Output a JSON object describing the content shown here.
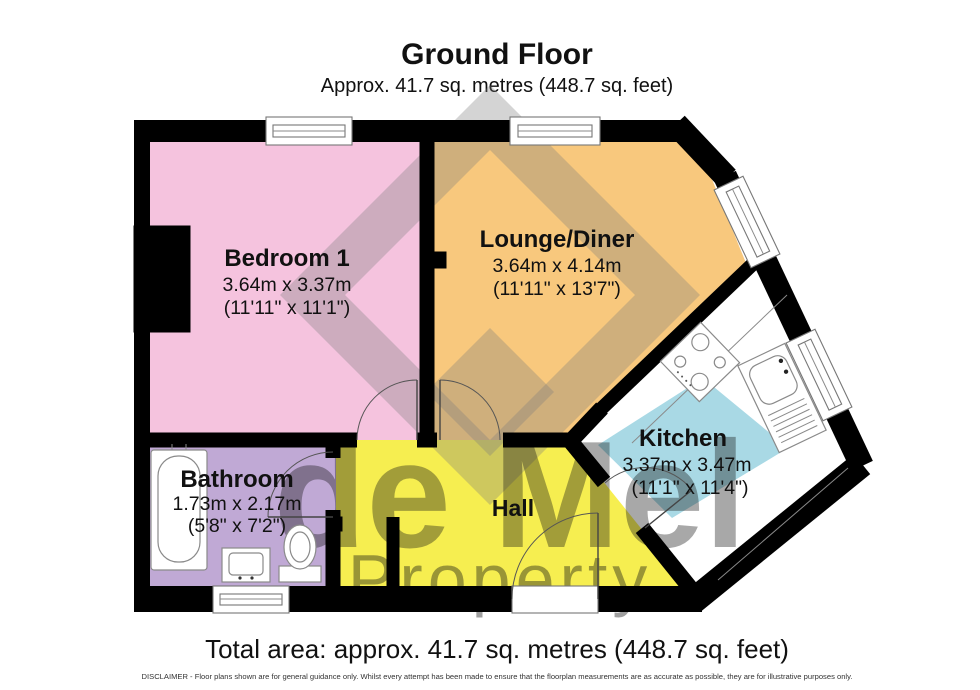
{
  "header": {
    "title": "Ground Floor",
    "subtitle": "Approx. 41.7 sq. metres (448.7 sq. feet)"
  },
  "footer": {
    "total": "Total area: approx. 41.7 sq. metres (448.7 sq. feet)",
    "disclaimer": "DISCLAIMER -  Floor plans shown are for general guidance only. Whilst every attempt has been made to ensure that the floorplan measurements are as accurate as possible, they are for illustrative purposes only."
  },
  "watermark": {
    "line1": "de Mel",
    "line2": "Property"
  },
  "rooms": {
    "bedroom": {
      "name": "Bedroom 1",
      "metric": "3.64m x 3.37m",
      "imperial": "(11'11\" x 11'1\")",
      "color": "#f5c3de"
    },
    "lounge": {
      "name": "Lounge/Diner",
      "metric": "3.64m x 4.14m",
      "imperial": "(11'11\" x 13'7\")",
      "color": "#f8c87d"
    },
    "kitchen": {
      "name": "Kitchen",
      "metric": "3.37m x 3.47m",
      "imperial": "(11'1\" x 11'4\")",
      "color": "#a9d9e5"
    },
    "bathroom": {
      "name": "Bathroom",
      "metric": "1.73m x 2.17m",
      "imperial": "(5'8\" x 7'2\")",
      "color": "#c0a9d5"
    },
    "hall": {
      "name": "Hall",
      "color": "#f6ee50"
    }
  },
  "colors": {
    "wall": "#000000",
    "watermark": "#7d7d7d",
    "kitchen_floor": "#ffffff"
  }
}
